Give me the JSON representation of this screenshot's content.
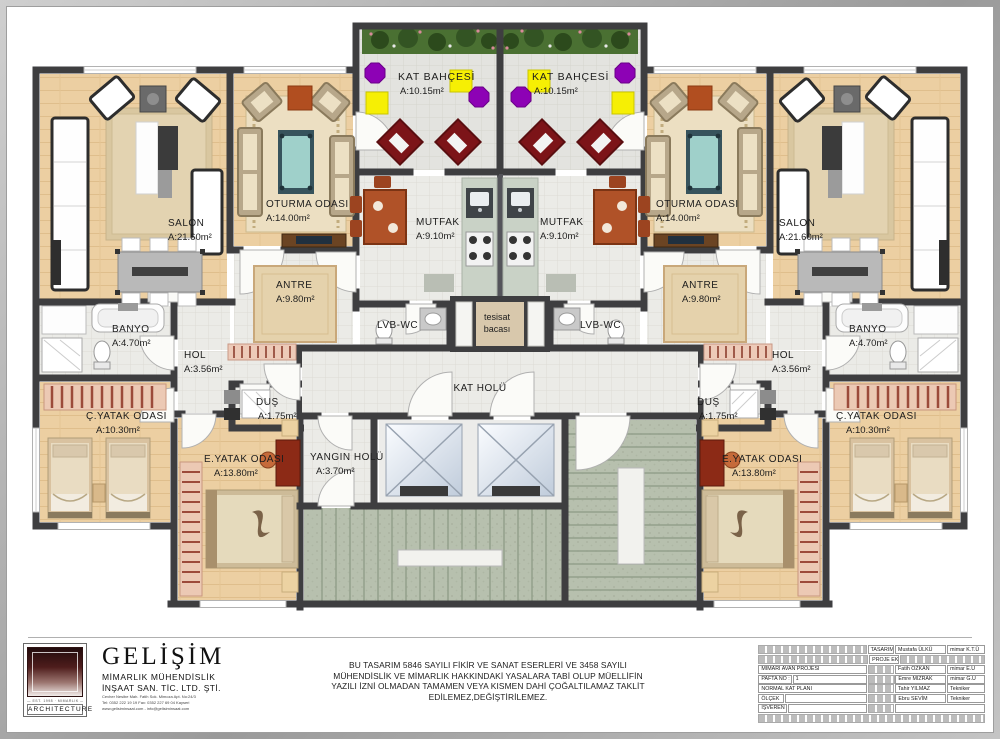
{
  "rooms": {
    "kat_bahcesi": {
      "name": "KAT BAHÇESİ",
      "area": "A:10.15m²"
    },
    "salon": {
      "name": "SALON",
      "area": "A:21.60m²"
    },
    "oturma_odasi": {
      "name": "OTURMA ODASI",
      "area": "A:14.00m²"
    },
    "antre": {
      "name": "ANTRE",
      "area": "A:9.80m²"
    },
    "mutfak": {
      "name": "MUTFAK",
      "area": "A:9.10m²"
    },
    "lvb_wc": {
      "name": "LVB-WC"
    },
    "tesisat": {
      "line1": "tesisat",
      "line2": "bacası"
    },
    "kat_holu": {
      "name": "KAT HOLÜ"
    },
    "banyo": {
      "name": "BANYO",
      "area": "A:4.70m²"
    },
    "hol": {
      "name": "HOL",
      "area": "A:3.56m²"
    },
    "dus": {
      "name": "DUŞ",
      "area": "A:1.75m²"
    },
    "c_yatak_odasi": {
      "name": "Ç.YATAK ODASI",
      "area": "A:10.30m²"
    },
    "e_yatak_odasi": {
      "name": "E.YATAK ODASI",
      "area": "A:13.80m²"
    },
    "yangin_holu": {
      "name": "YANGIN HOLÜ",
      "area": "A:3.70m²"
    }
  },
  "footer": {
    "logo": {
      "architecture": "ARCHITECTURE",
      "brand": "GELİŞİM",
      "line1": "MİMARLIK   MÜHENDİSLİK",
      "line2": "İNŞAAT SAN. TİC. LTD. ŞTİ.",
      "small1": "Cevher Nesibe Mah. Fatih Sok. Mimoza Apt. No:24/3",
      "small2": "Tel: 0352 222 19 19   Fax: 0352 227 69 04   Kayseri",
      "small3": "www.gelisiminsaat.com  -  info@gelisiminsaat.com",
      "tiny": "— EST. 1998 · MİMARLIK — İNŞAAT —"
    },
    "disclaimer": {
      "l1": "BU TASARIM 5846 SAYILI FİKİR VE SANAT ESERLERİ VE 3458 SAYILI",
      "l2": "MÜHENDİSLİK VE MİMARLIK HAKKINDAKİ YASALARA TABİ OLUP MÜELLİFİN",
      "l3": "YAZILI İZNİ OLMADAN TAMAMEN VEYA KISMEN DAHİ ÇOĞALTILAMAZ TAKLİT",
      "l4": "EDİLEMEZ,DEĞİŞTİRİLEMEZ."
    },
    "titleblock": {
      "tasarim_label": "TASARIM",
      "tasarim_name": "Mustafa ÜLKÜ",
      "tasarim_title": "mimar  K.T.Ü",
      "proje_ekibi": "PROJE EKİBİ",
      "row_proje": "MİMARİ AVAN PROJESİ",
      "row_pafta_label": "PAFTA NO :",
      "row_pafta_value": "1",
      "row_plan": "NORMAL KAT PLANI",
      "row_olcek": "ÖLÇEK",
      "row_isveren": "İŞVEREN",
      "team": [
        {
          "name": "Fatih ÖZKAN",
          "title": "mimar  E.Ü"
        },
        {
          "name": "Emre MIZRAK",
          "title": "mimar  G.Ü"
        },
        {
          "name": "Tahir YILMAZ",
          "title": "Tekniker"
        },
        {
          "name": "Ebru SEVİM",
          "title": "Tekniker"
        }
      ]
    }
  },
  "colors": {
    "wall": "#3e3e40",
    "wood_floor": "#eccfa2",
    "tile_floor": "#ebebe7",
    "garden_green": "#4a7032",
    "stair": "#b7c0ae",
    "accent_yellow": "#f6ef04",
    "accent_purple": "#8d02b5",
    "accent_maroon": "#7c1418"
  }
}
